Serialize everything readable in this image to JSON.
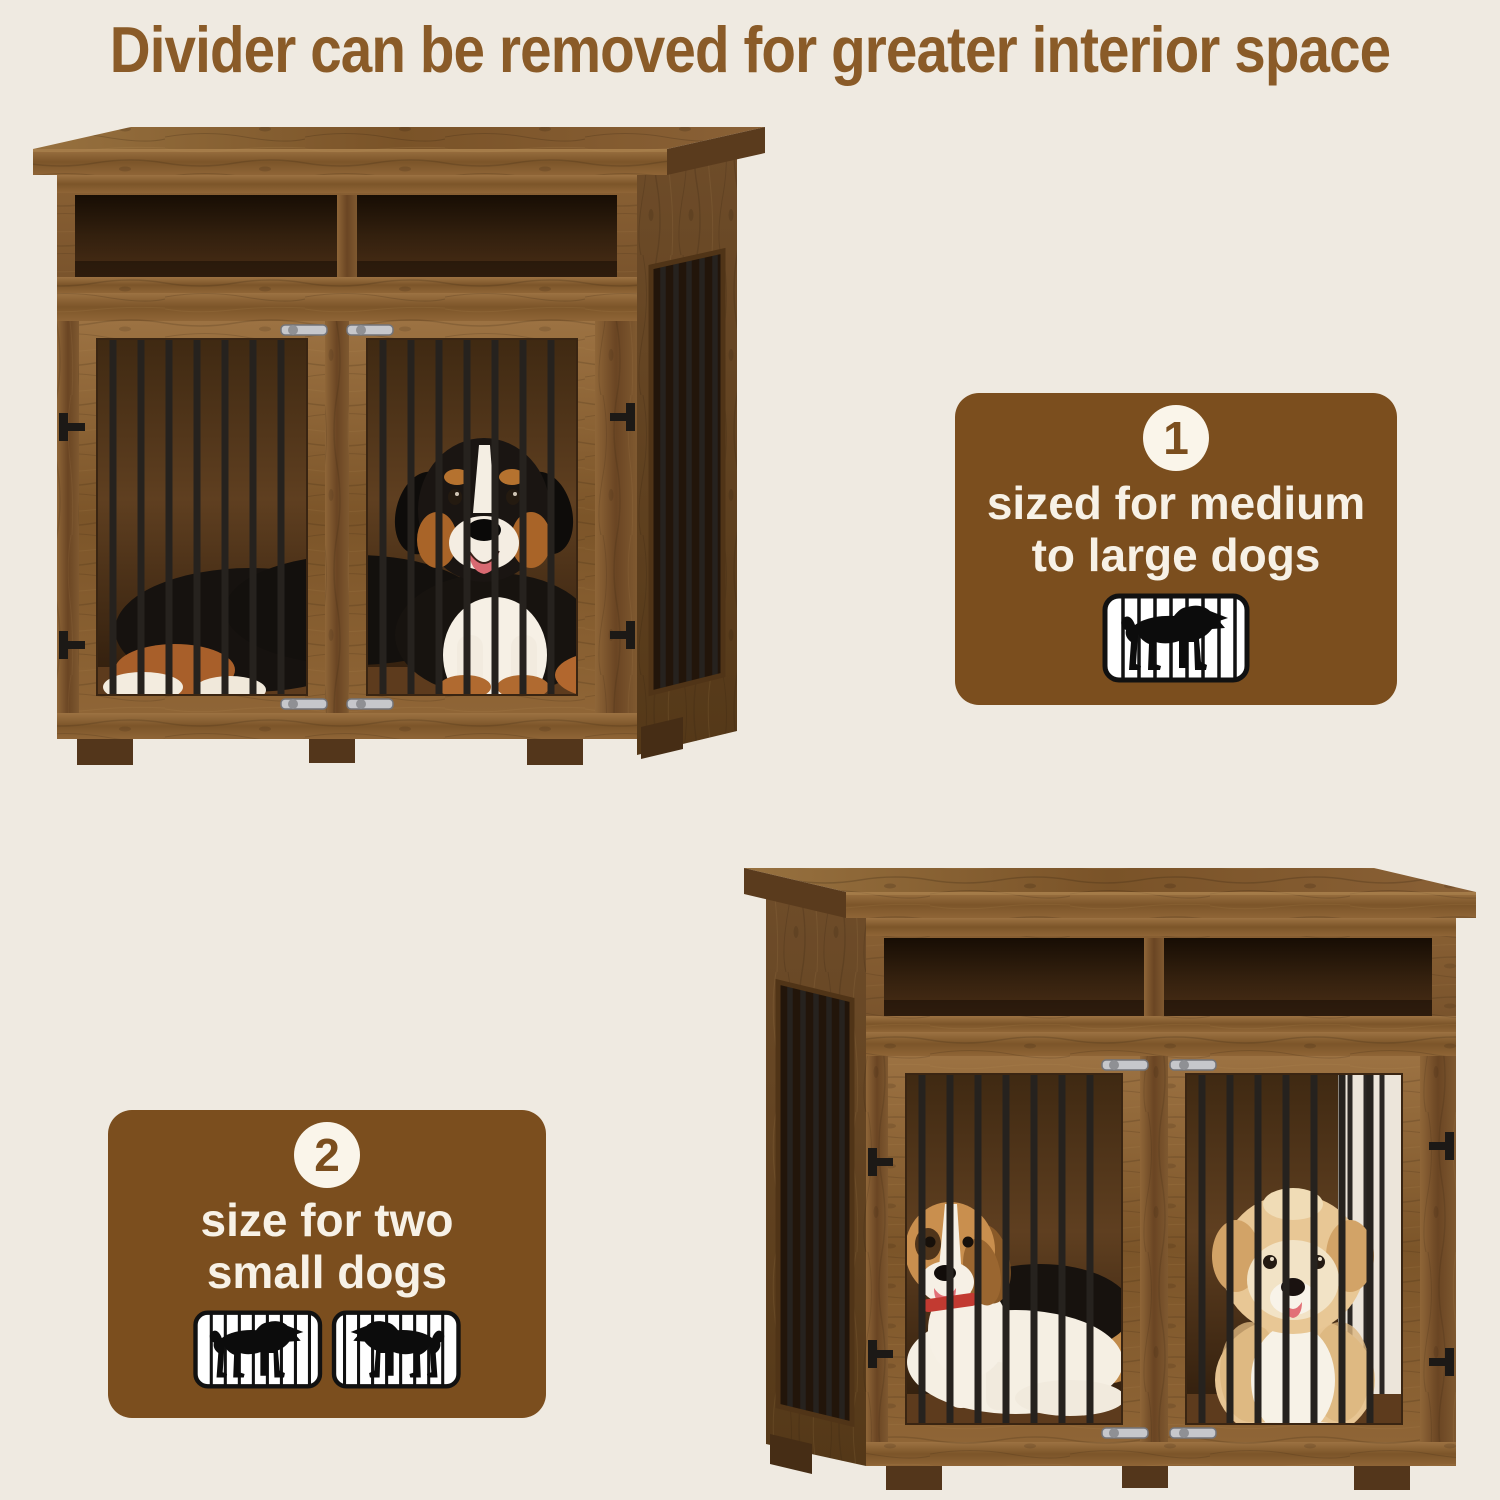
{
  "page": {
    "background_color": "#efeae1"
  },
  "title": {
    "text": "Divider can be removed for greater interior space",
    "color": "#8a5b28"
  },
  "scene": {
    "crate_top_left": {
      "description": "rustic wooden dog crate furniture with storage shelf, divider removed, one large Bernese Mountain Dog lying across the full interior behind black metal bars",
      "wood_color": "#7a5530",
      "bar_color": "#26221e"
    },
    "crate_bottom_right": {
      "description": "same wooden dog crate with center divider installed, a beagle in the left compartment and a small fluffy cream dog in the right compartment",
      "wood_color": "#7a5530",
      "bar_color": "#26221e"
    }
  },
  "badges": [
    {
      "number": "1",
      "label": "sized for medium to large dogs",
      "lines": [
        "sized for medium",
        "to large dogs"
      ],
      "icon": "dog-in-cage",
      "bg": "#7b4e1e",
      "text_color": "#f7f1e6",
      "circle_color": "#faf5ea"
    },
    {
      "number": "2",
      "label": "size for two small dogs",
      "lines": [
        "size for two",
        "small dogs"
      ],
      "icon": "two-dogs-in-cages",
      "bg": "#7b4e1e",
      "text_color": "#f7f1e6",
      "circle_color": "#faf5ea"
    }
  ]
}
